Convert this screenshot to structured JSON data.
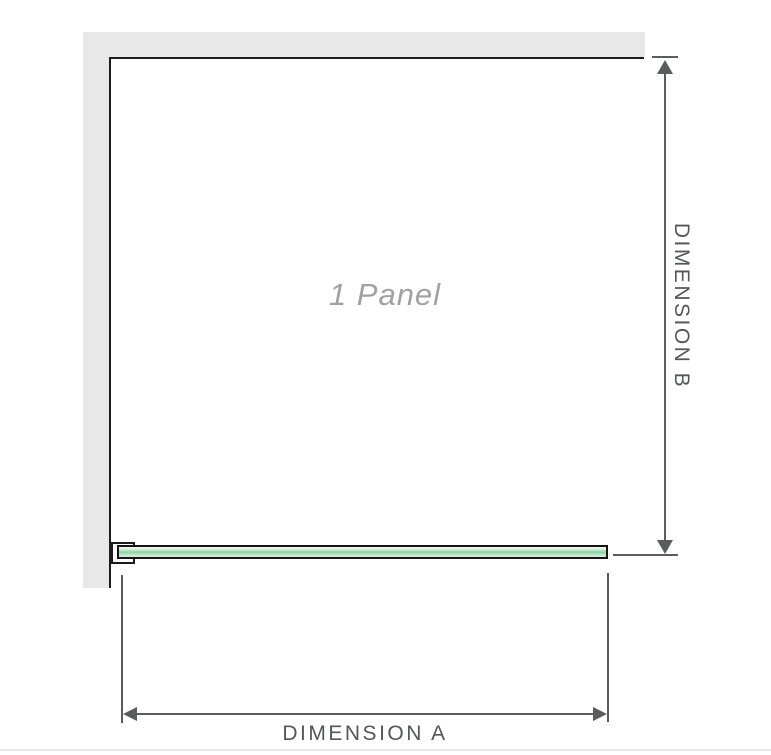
{
  "diagram": {
    "panel_label": "1 Panel",
    "dimension_a_label": "DIMENSION A",
    "dimension_b_label": "DIMENSION B"
  },
  "icons": {
    "dim_b_top": "arrow-up-icon",
    "dim_b_bottom": "arrow-down-icon",
    "dim_a_left": "arrow-left-icon",
    "dim_a_right": "arrow-right-icon"
  },
  "colors": {
    "wall": "#e8e8e8",
    "outline": "#1c1c1c",
    "dimension_line": "#5b5c5e",
    "dimension_text": "#55565a",
    "glass_edge": "#141414",
    "glass_light": "#d9efe0",
    "glass_mid": "#8fd0a5",
    "panel_label_text": "#a1a1a5",
    "background": "#ffffff"
  }
}
